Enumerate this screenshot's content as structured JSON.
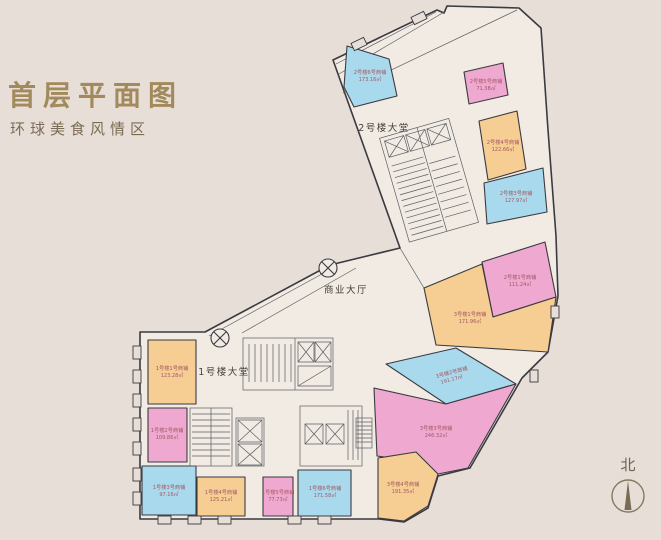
{
  "title": "首层平面图",
  "subtitle": "环球美食风情区",
  "north_label": "北",
  "palette": {
    "background": "#e7dfd7",
    "floor": "#f1ebe4",
    "wall": "#3a3a40",
    "blue": "#a9d9ec",
    "pink": "#efa9d0",
    "orange": "#f6cd92",
    "room_label": "#a35862",
    "plan_text": "#45413c",
    "title": "#a38a5c",
    "subtitle": "#7b6b54",
    "north": "#7c6d59"
  },
  "plan_labels": {
    "lobby2": "2号楼大堂",
    "hall": "商业大厅",
    "lobby1": "1号楼大堂"
  },
  "rooms": [
    {
      "id": "u1",
      "name": "2号楼6号商铺",
      "area": "173.16㎡",
      "color": "blue"
    },
    {
      "id": "u2",
      "name": "2号楼5号商铺",
      "area": "71.38㎡",
      "color": "pink"
    },
    {
      "id": "u3",
      "name": "2号楼4号商铺",
      "area": "122.66㎡",
      "color": "orange"
    },
    {
      "id": "u4",
      "name": "2号楼3号商铺",
      "area": "127.97㎡",
      "color": "blue"
    },
    {
      "id": "pink-a",
      "name": "2号楼1号商铺",
      "area": "111.24㎡",
      "color": "pink"
    },
    {
      "id": "orange-a",
      "name": "3号楼1号商铺",
      "area": "171.96㎡",
      "color": "orange"
    },
    {
      "id": "blue-b",
      "name": "3号楼2号商铺",
      "area": "191.17㎡",
      "color": "blue"
    },
    {
      "id": "pink-b",
      "name": "3号楼3号商铺",
      "area": "246.32㎡",
      "color": "pink"
    },
    {
      "id": "orange-b",
      "name": "3号楼4号商铺",
      "area": "191.35㎡",
      "color": "orange"
    },
    {
      "id": "o1",
      "name": "1号楼1号商铺",
      "area": "123.28㎡",
      "color": "orange"
    },
    {
      "id": "p1",
      "name": "1号楼2号商铺",
      "area": "109.86㎡",
      "color": "pink"
    },
    {
      "id": "b2",
      "name": "1号楼3号商铺",
      "area": "97.16㎡",
      "color": "blue"
    },
    {
      "id": "o2",
      "name": "1号楼4号商铺",
      "area": "125.21㎡",
      "color": "orange"
    },
    {
      "id": "p2",
      "name": "1号楼5号商铺",
      "area": "77.73㎡",
      "color": "pink"
    },
    {
      "id": "b3",
      "name": "1号楼6号商铺",
      "area": "171.58㎡",
      "color": "blue"
    }
  ]
}
